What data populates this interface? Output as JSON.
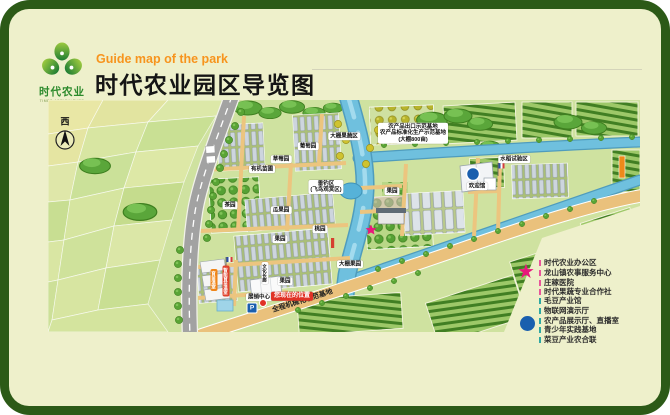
{
  "header": {
    "subtitle_en": "Guide map of the park",
    "title": "时代农业园区导览图",
    "logo": {
      "cn": "时代农业",
      "en": "TIMES AGRICULTURE"
    }
  },
  "map": {
    "compass_west": "西",
    "parking": "P",
    "road_banner": "全程机械化示范基地",
    "you_are_here": "您现在的位置",
    "labels": {
      "greenhouse_zone": "大棚果蔬区",
      "grape": "葡萄园",
      "strawberry": "草莓园",
      "nursery": "有机苗圃",
      "fishing_line1": "垂钓区",
      "fishing_line2": "(飞鸟观赏区)",
      "tea": "茶园",
      "melon": "瓜果园",
      "orchard1": "果园",
      "peach": "桃园",
      "greenhouse_orchard": "大棚果园",
      "orchard2": "果园",
      "orchard3": "果园",
      "base_line1": "农产品出口示范基地",
      "base_line2": "农产品标准化生产示范基地",
      "base_line3": "(大棚800亩)",
      "welcome_hall": "欢迎馆",
      "rice": "水稻试验区",
      "exhibition": "展销中心",
      "corridor": "文化长廊",
      "seedling_orange": "育苗温室",
      "seedling_red": "智能育苗温室"
    }
  },
  "legend": {
    "star_icon": "★",
    "star_color": "#e8187c",
    "dot_color": "#1a5fae",
    "star_items": [
      "时代农业办公区",
      "龙山镇农事服务中心",
      "庄稼医院",
      "时代果蔬专业合作社"
    ],
    "dot_items": [
      "毛豆产业馆",
      "物联网演示厅",
      "农产品展示厅、直播室",
      "青少年实践基地",
      "菜豆产业农合联"
    ]
  },
  "colors": {
    "frame": "#2c5a17",
    "card": "#eef0cb",
    "title_accent": "#f7941d",
    "logo_green": "#2c8a2c",
    "you_are_here_red": "#e03226"
  }
}
